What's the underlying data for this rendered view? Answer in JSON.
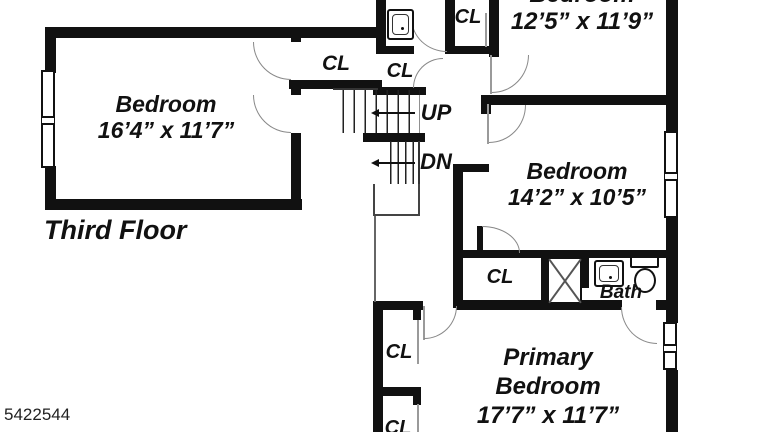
{
  "floor_label": "Third Floor",
  "mls_number": "5422544",
  "rooms": {
    "bedroom_left": {
      "name": "Bedroom",
      "dims": "16’4” x 11’7”"
    },
    "bedroom_top_right": {
      "name": "Bedroom",
      "dims": "12’5” x 11’9”"
    },
    "bedroom_mid_right": {
      "name": "Bedroom",
      "dims": "14’2” x 10’5”"
    },
    "primary_bedroom": {
      "name_line1": "Primary",
      "name_line2": "Bedroom",
      "dims": "17’7” x 11’7”"
    }
  },
  "labels": {
    "closet": "CL",
    "bath": "Bath",
    "stairs_up": "UP",
    "stairs_down": "DN"
  },
  "colors": {
    "wall": "#111111",
    "background": "#ffffff",
    "thin_line": "#888888"
  }
}
